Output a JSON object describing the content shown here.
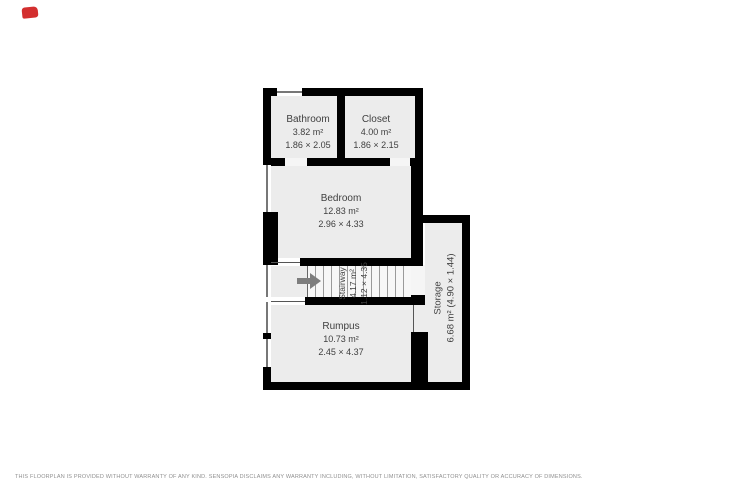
{
  "page": {
    "background": "#ffffff",
    "wall_color": "#000000",
    "floor_color": "#ececec",
    "text_color": "#3f3f3f",
    "marker_color": "#d32f2f"
  },
  "rooms": [
    {
      "name": "Bathroom",
      "area": "3.82 m²",
      "dims": "1.86 × 2.05"
    },
    {
      "name": "Closet",
      "area": "4.00 m²",
      "dims": "1.86 × 2.15"
    },
    {
      "name": "Bedroom",
      "area": "12.83 m²",
      "dims": "2.96 × 4.33"
    },
    {
      "name": "Stairway",
      "area": "4.17 m²",
      "dims": "1.12 × 4.35"
    },
    {
      "name": "Rumpus",
      "area": "10.73 m²",
      "dims": "2.45 × 4.37"
    },
    {
      "name": "Storage",
      "area_dims": "6.68 m² (4.90 × 1.44)"
    }
  ],
  "icons": {
    "stairs_arrow": "right-arrow"
  },
  "footer": {
    "disclaimer": "THIS FLOORPLAN IS PROVIDED WITHOUT WARRANTY OF ANY KIND. SENSOPIA DISCLAIMS ANY WARRANTY INCLUDING, WITHOUT LIMITATION, SATISFACTORY QUALITY OR ACCURACY OF DIMENSIONS."
  }
}
